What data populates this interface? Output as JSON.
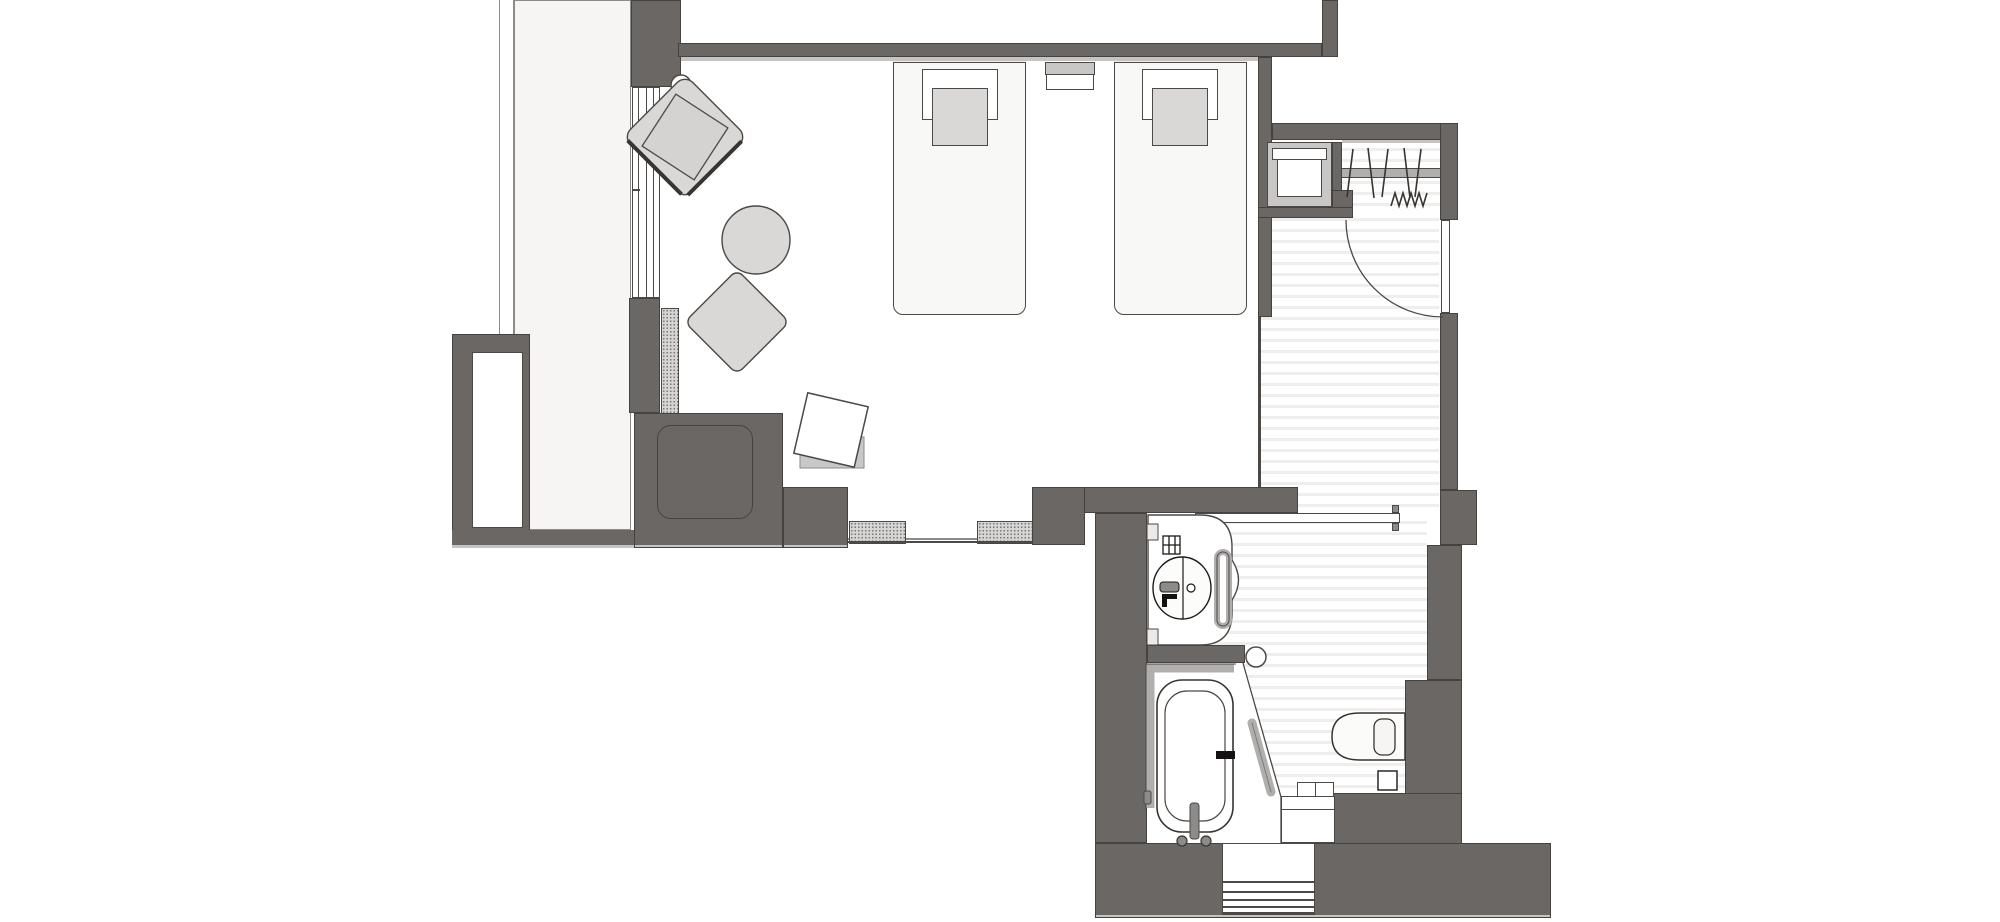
{
  "drawing": {
    "kind": "architectural-floor-plan",
    "visible_text": "none"
  },
  "colors": {
    "wall": "#6a6764",
    "wall-edge": "#45423f",
    "line": "#4b4846",
    "shadow": "#c6c4c2",
    "panel": "#f6f5f4",
    "panel-edge": "#8d8b89",
    "stripe": "#efeeed",
    "floor": "#ffffff",
    "furn": "#d9d8d6",
    "furn-dark": "#c9c7c5",
    "bed": "#f8f8f7",
    "band": "#efeeec",
    "metal": "#b1afad",
    "dot": "#7a7774",
    "dot-bg": "#d7d5d3",
    "ink": "#141210"
  },
  "elements": [
    "balcony-rail",
    "balcony-panel",
    "window-band",
    "curtain-track",
    "armchair",
    "armchair-cushion",
    "round-side-table",
    "ottoman",
    "dark-cabinet",
    "wall-niche",
    "desk-nook",
    "desk-vent-left",
    "desk-vent-right",
    "desk-chair",
    "twin-bed-1",
    "twin-bed-2",
    "pillow",
    "nightstand",
    "luggage-rack",
    "closet",
    "hanger-rod",
    "hangers",
    "hook-strip",
    "entry-door",
    "entry-door-swing",
    "entry-hall",
    "entry-steps",
    "sliding-door",
    "door-knob",
    "door-stopper",
    "vanity",
    "wash-basin",
    "basin-faucet",
    "shelf-grid",
    "towel-ring",
    "bathtub",
    "tub-ledge",
    "tub-faucet",
    "tub-handles",
    "shower-screen",
    "toilet",
    "toilet-lid",
    "waste-bin",
    "bath-counter"
  ]
}
